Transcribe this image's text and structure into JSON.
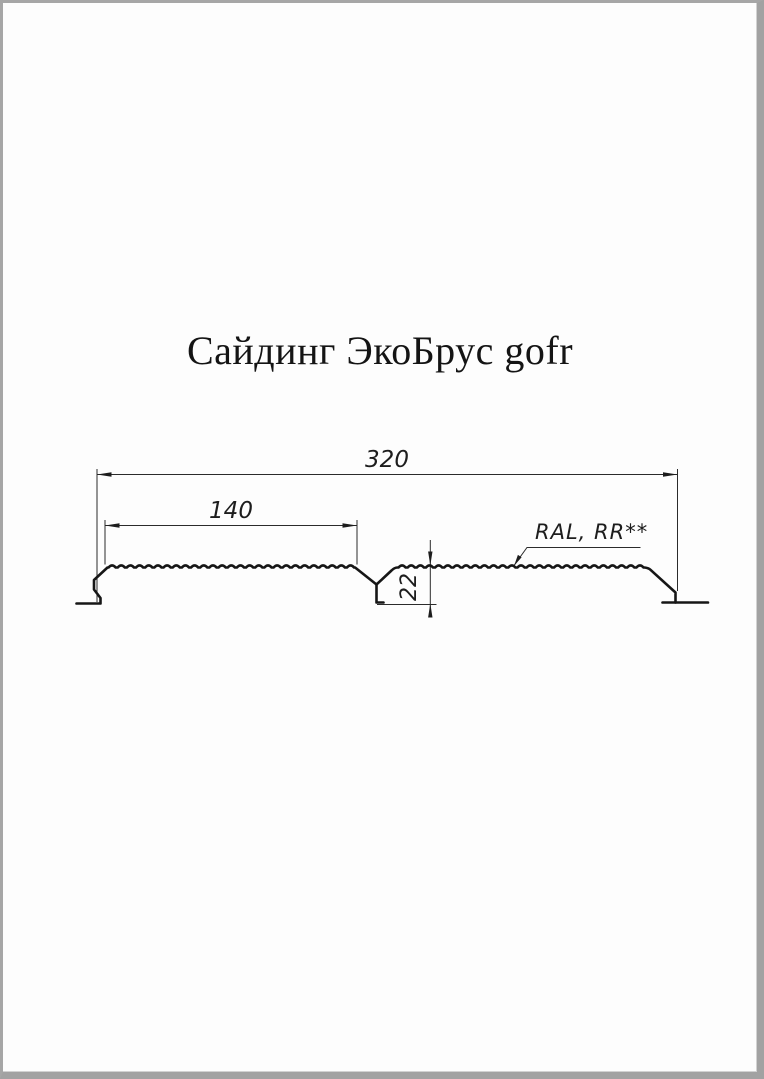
{
  "title": "Сайдинг ЭкоБрус gofr",
  "diagram": {
    "type": "technical-profile-drawing",
    "product_name": "Сайдинг ЭкоБрус gofr",
    "dimensions": {
      "overall_width_mm": "320",
      "face_width_mm": "140",
      "profile_height_mm": "22"
    },
    "coating_label": "RAL, RR**",
    "colors": {
      "profile_line": "#161616",
      "thin_line": "#2b2b2b",
      "page_background": "#fdfdfd",
      "frame": "#a2a2a2"
    }
  }
}
